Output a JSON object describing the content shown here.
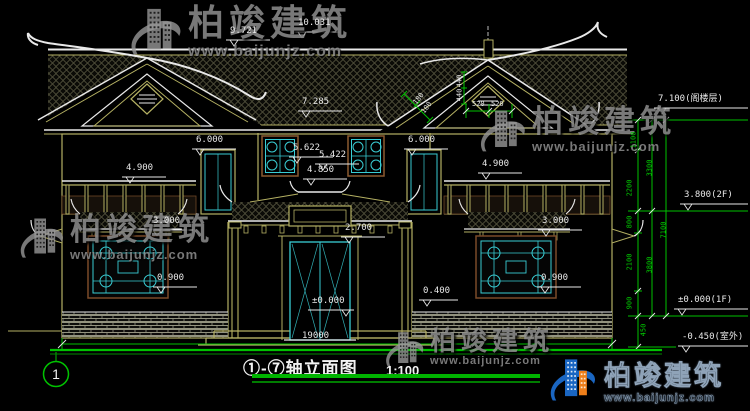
{
  "meta": {
    "drawing_type": "建筑立面图",
    "background": "#000000"
  },
  "title": {
    "text": "①-⑦轴立面图",
    "scale": "1:100"
  },
  "axis": {
    "number": "1"
  },
  "watermark": {
    "brand": "柏竣建筑",
    "url": "www.baijunjz.com"
  },
  "colors": {
    "line_olive": "#b5b163",
    "line_white": "#e9e9e9",
    "line_cyan": "#39cdd4",
    "dim_green": "#00c200",
    "brand_blue": "#1a66c2",
    "brand_orange": "#ef7f1a"
  },
  "labels": [
    {
      "t": "9.721",
      "x": 230,
      "y": 27,
      "cls": "dim"
    },
    {
      "t": "10.031",
      "x": 298,
      "y": 19,
      "cls": "dim"
    },
    {
      "t": "7.285",
      "x": 302,
      "y": 98,
      "cls": "dim"
    },
    {
      "t": "6.000",
      "x": 196,
      "y": 136,
      "cls": "dim"
    },
    {
      "t": "6.000",
      "x": 408,
      "y": 136,
      "cls": "dim"
    },
    {
      "t": "5.622",
      "x": 293,
      "y": 144,
      "cls": "dim"
    },
    {
      "t": "5.422",
      "x": 319,
      "y": 151,
      "cls": "dim"
    },
    {
      "t": "4.850",
      "x": 307,
      "y": 166,
      "cls": "dim"
    },
    {
      "t": "4.900",
      "x": 126,
      "y": 164,
      "cls": "dim"
    },
    {
      "t": "4.900",
      "x": 482,
      "y": 160,
      "cls": "dim"
    },
    {
      "t": "3.000",
      "x": 153,
      "y": 217,
      "cls": "dim"
    },
    {
      "t": "3.000",
      "x": 542,
      "y": 217,
      "cls": "dim"
    },
    {
      "t": "0.900",
      "x": 157,
      "y": 274,
      "cls": "dim"
    },
    {
      "t": "0.900",
      "x": 541,
      "y": 274,
      "cls": "dim"
    },
    {
      "t": "0.400",
      "x": 423,
      "y": 287,
      "cls": "dim"
    },
    {
      "t": "2.700",
      "x": 345,
      "y": 224,
      "cls": "dim"
    },
    {
      "t": "±0.000",
      "x": 312,
      "y": 297,
      "cls": "dim"
    },
    {
      "t": "19000",
      "x": 302,
      "y": 332,
      "cls": "dim"
    },
    {
      "t": "520",
      "x": 472,
      "y": 101,
      "cls": "small"
    },
    {
      "t": "520",
      "x": 491,
      "y": 101,
      "cls": "small"
    },
    {
      "t": "440",
      "x": 460,
      "y": 81,
      "rot": -90,
      "cls": "small"
    },
    {
      "t": "440",
      "x": 460,
      "y": 95,
      "rot": -90,
      "cls": "small"
    },
    {
      "t": "180",
      "x": 419,
      "y": 99,
      "rot": -52,
      "cls": "small"
    },
    {
      "t": "100",
      "x": 427,
      "y": 108,
      "rot": -52,
      "cls": "small"
    },
    {
      "t": "7.100(阁楼层)",
      "x": 658,
      "y": 95,
      "cls": "lvl"
    },
    {
      "t": "3.800(2F)",
      "x": 684,
      "y": 191,
      "cls": "lvl"
    },
    {
      "t": "±0.000(1F)",
      "x": 678,
      "y": 296,
      "cls": "lvl"
    },
    {
      "t": "-0.450(室外)",
      "x": 682,
      "y": 333,
      "cls": "lvl"
    },
    {
      "t": "1100",
      "x": 634,
      "y": 140,
      "rot": -90,
      "cls": "dimg"
    },
    {
      "t": "3300",
      "x": 650,
      "y": 168,
      "rot": -90,
      "cls": "dimg"
    },
    {
      "t": "2200",
      "x": 630,
      "y": 188,
      "rot": -90,
      "cls": "dimg"
    },
    {
      "t": "800",
      "x": 630,
      "y": 222,
      "rot": -90,
      "cls": "dimg"
    },
    {
      "t": "7100",
      "x": 664,
      "y": 230,
      "rot": -90,
      "cls": "dimg"
    },
    {
      "t": "2100",
      "x": 630,
      "y": 262,
      "rot": -90,
      "cls": "dimg"
    },
    {
      "t": "3800",
      "x": 650,
      "y": 265,
      "rot": -90,
      "cls": "dimg"
    },
    {
      "t": "900",
      "x": 630,
      "y": 303,
      "rot": -90,
      "cls": "dimg"
    },
    {
      "t": "450",
      "x": 644,
      "y": 330,
      "rot": -90,
      "cls": "dimg"
    }
  ]
}
